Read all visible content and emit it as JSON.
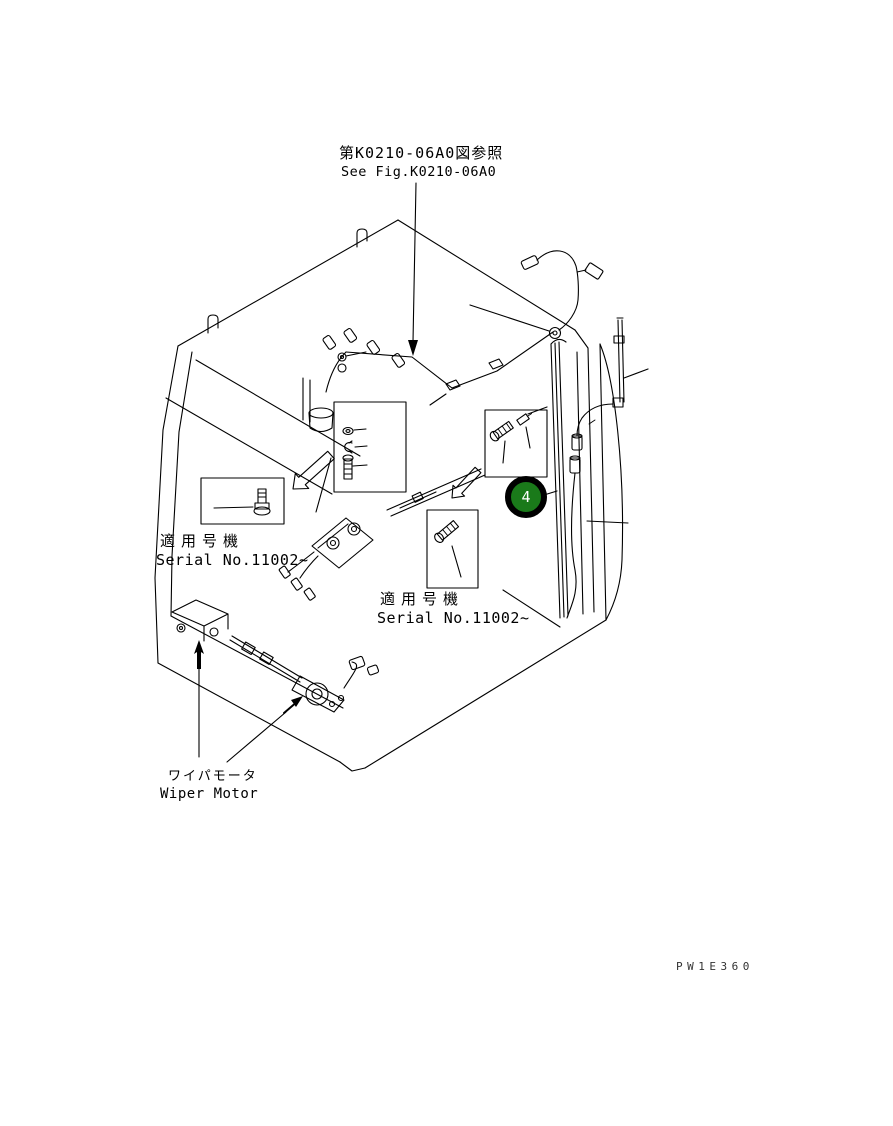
{
  "page": {
    "background_color": "#ffffff",
    "line_color": "#000000"
  },
  "reference_note": {
    "jp": "第K0210-06A0図参照",
    "en": "See Fig.K0210-06A0"
  },
  "left_serial_note": {
    "jp": "適用号機",
    "en": "Serial No.11002~"
  },
  "right_serial_note": {
    "jp": "適用号機",
    "en": "Serial No.11002~"
  },
  "wiper_motor_label": {
    "jp": "ワイパモータ",
    "en": "Wiper Motor"
  },
  "callout_4": {
    "number": "4",
    "fill": "#1a7a1a",
    "ring": "#000000",
    "text_color": "#ffffff"
  },
  "doc_code": "PW1E360"
}
